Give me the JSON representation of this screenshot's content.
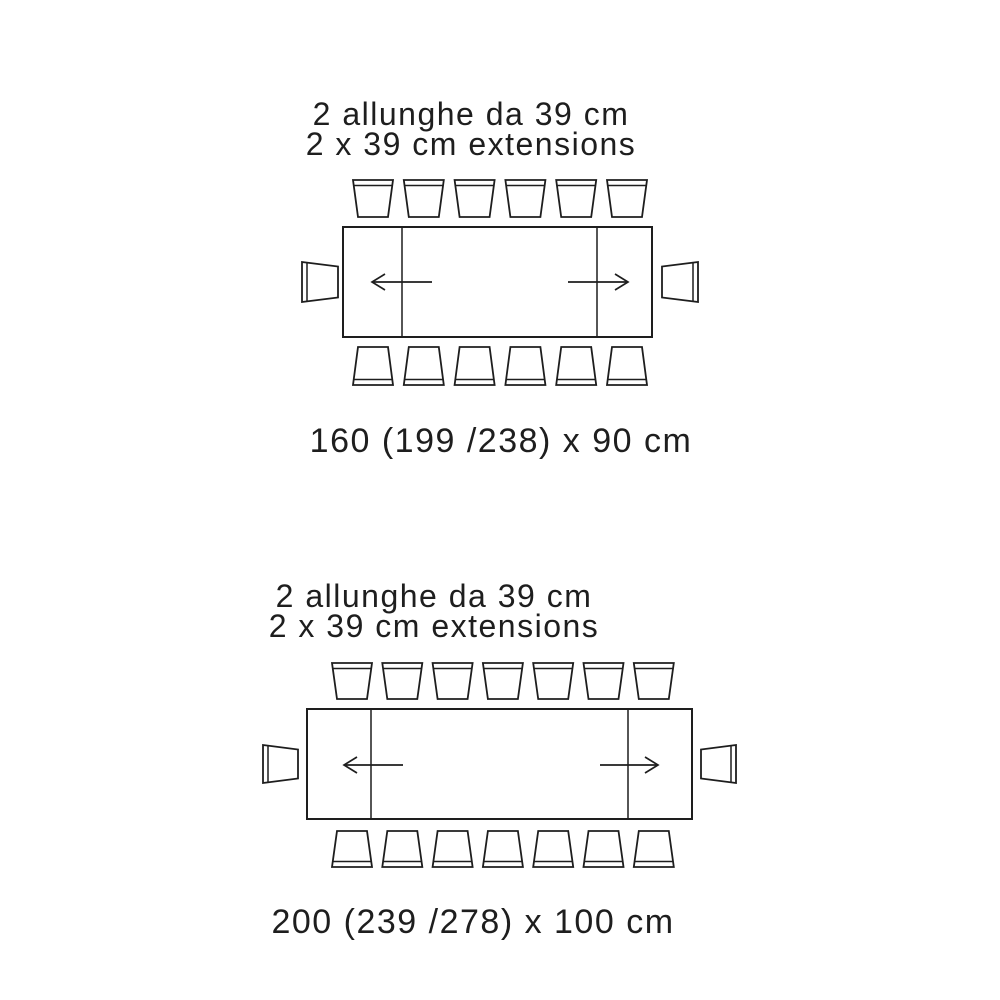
{
  "page": {
    "background": "#ffffff",
    "ink": "#1e1e1e"
  },
  "diagrams": [
    {
      "id": "table-160",
      "title_line1": "2 allunghe da 39 cm",
      "title_line2": "2 x 39 cm extensions",
      "size_label": "160 (199 /238) x 90 cm",
      "extensions_count": 2,
      "extension_size_cm": 39,
      "chairs": {
        "top": 6,
        "bottom": 6,
        "left": 1,
        "right": 1
      }
    },
    {
      "id": "table-200",
      "title_line1": "2 allunghe da 39 cm",
      "title_line2": "2 x 39 cm extensions",
      "size_label": "200 (239 /278) x 100 cm",
      "extensions_count": 2,
      "extension_size_cm": 39,
      "chairs": {
        "top": 7,
        "bottom": 7,
        "left": 1,
        "right": 1
      }
    }
  ]
}
